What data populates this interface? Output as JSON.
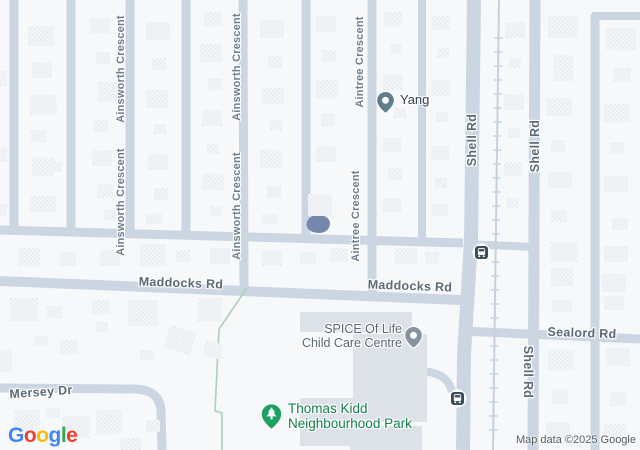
{
  "map": {
    "width": 640,
    "height": 450,
    "background": "#f7f8f9",
    "colors": {
      "road": "#ccd6e2",
      "rail": "#c6d1dd",
      "building": "#e8ebf1",
      "structure": "#dde1e8",
      "water": "#7488ae",
      "park_line": "#abd0b8",
      "street_label": "#6e7d8c",
      "major_label": "#5b6a76"
    }
  },
  "roads": [
    {
      "d": "M14,0 L14,234",
      "w": 9
    },
    {
      "d": "M71,0 L71,234",
      "w": 9
    },
    {
      "d": "M130,0 L130,234",
      "w": 9
    },
    {
      "d": "M186,0 L186,234",
      "w": 9
    },
    {
      "d": "M243,0 L244,296",
      "w": 9
    },
    {
      "d": "M306,0 L306,234",
      "w": 9
    },
    {
      "d": "M372,0 L372,297",
      "w": 9
    },
    {
      "d": "M422,0 L422,240",
      "w": 8
    },
    {
      "d": "M474,0 L471,240 L464,355 L463,450",
      "w": 14
    },
    {
      "d": "M535,0 L533,450",
      "w": 11
    },
    {
      "d": "M595,14 L595,450",
      "w": 9
    },
    {
      "d": "M592,16 L640,16",
      "w": 8
    },
    {
      "d": "M0,230 L463,243",
      "w": 9
    },
    {
      "d": "M464,244 L535,247",
      "w": 8
    },
    {
      "d": "M0,281 L461,300",
      "w": 10
    },
    {
      "d": "M461,331 L640,339",
      "w": 9
    },
    {
      "d": "M0,388 L136,389 Q159,390 161,410 L162,450",
      "w": 9
    },
    {
      "d": "M420,371 Q448,372 452,392",
      "w": 8
    }
  ],
  "rail": {
    "x_top": 499,
    "x_bottom": 493,
    "tick_spacing": 14,
    "tick_half": 4,
    "y_start": 38,
    "y_end": 438,
    "line_w": 2
  },
  "pond": {
    "d": "M312,216 Q305,221 307,227 Q310,233 320,233 Q329,232 330,224 Q330,217 321,215 Z"
  },
  "park_boundary": {
    "d": "M247,288 L219,329 L215,411 L222,413 L222,450"
  },
  "buildings": [
    [
      28,
      26,
      26,
      20
    ],
    [
      32,
      62,
      20,
      16
    ],
    [
      30,
      95,
      26,
      20
    ],
    [
      47,
      100,
      10,
      8
    ],
    [
      30,
      130,
      16,
      12
    ],
    [
      32,
      158,
      22,
      18
    ],
    [
      52,
      162,
      10,
      10
    ],
    [
      30,
      196,
      26,
      16
    ],
    [
      0,
      70,
      7,
      16
    ],
    [
      0,
      148,
      7,
      14
    ],
    [
      0,
      204,
      7,
      12
    ],
    [
      90,
      18,
      20,
      16
    ],
    [
      96,
      52,
      14,
      12
    ],
    [
      98,
      82,
      22,
      20
    ],
    [
      94,
      120,
      14,
      12
    ],
    [
      92,
      150,
      20,
      16
    ],
    [
      97,
      184,
      16,
      14
    ],
    [
      104,
      210,
      12,
      10
    ],
    [
      146,
      22,
      24,
      18
    ],
    [
      152,
      58,
      14,
      12
    ],
    [
      146,
      90,
      22,
      18
    ],
    [
      154,
      124,
      12,
      10
    ],
    [
      148,
      154,
      20,
      16
    ],
    [
      154,
      188,
      14,
      12
    ],
    [
      146,
      214,
      16,
      10
    ],
    [
      204,
      12,
      18,
      14
    ],
    [
      200,
      44,
      22,
      18
    ],
    [
      208,
      78,
      14,
      12
    ],
    [
      202,
      110,
      20,
      16
    ],
    [
      207,
      144,
      12,
      10
    ],
    [
      202,
      174,
      22,
      16
    ],
    [
      210,
      206,
      12,
      10
    ],
    [
      260,
      20,
      24,
      18
    ],
    [
      268,
      56,
      14,
      12
    ],
    [
      262,
      88,
      22,
      16
    ],
    [
      270,
      120,
      12,
      10
    ],
    [
      260,
      150,
      22,
      18
    ],
    [
      267,
      186,
      14,
      12
    ],
    [
      262,
      214,
      16,
      10
    ],
    [
      316,
      16,
      20,
      16
    ],
    [
      322,
      50,
      14,
      12
    ],
    [
      316,
      80,
      22,
      18
    ],
    [
      321,
      114,
      14,
      12
    ],
    [
      316,
      146,
      20,
      16
    ],
    [
      308,
      194,
      24,
      22
    ],
    [
      384,
      12,
      18,
      14
    ],
    [
      390,
      44,
      12,
      10
    ],
    [
      383,
      74,
      20,
      16
    ],
    [
      394,
      108,
      12,
      10
    ],
    [
      383,
      138,
      18,
      14
    ],
    [
      388,
      168,
      14,
      12
    ],
    [
      383,
      198,
      18,
      14
    ],
    [
      432,
      16,
      18,
      14
    ],
    [
      437,
      48,
      12,
      10
    ],
    [
      431,
      80,
      20,
      16
    ],
    [
      436,
      112,
      12,
      10
    ],
    [
      431,
      146,
      18,
      14
    ],
    [
      435,
      178,
      12,
      10
    ],
    [
      432,
      204,
      16,
      12
    ],
    [
      505,
      22,
      20,
      16
    ],
    [
      509,
      58,
      12,
      10
    ],
    [
      504,
      94,
      20,
      16
    ],
    [
      508,
      128,
      12,
      10
    ],
    [
      504,
      162,
      18,
      14
    ],
    [
      507,
      198,
      12,
      10
    ],
    [
      548,
      16,
      30,
      22
    ],
    [
      553,
      55,
      20,
      26
    ],
    [
      546,
      98,
      26,
      18
    ],
    [
      551,
      140,
      14,
      12
    ],
    [
      548,
      172,
      24,
      16
    ],
    [
      551,
      210,
      16,
      12
    ],
    [
      550,
      242,
      28,
      20
    ],
    [
      551,
      268,
      22,
      18
    ],
    [
      552,
      300,
      20,
      12
    ],
    [
      548,
      350,
      26,
      20
    ],
    [
      552,
      390,
      16,
      14
    ],
    [
      546,
      422,
      24,
      18
    ],
    [
      606,
      28,
      30,
      22
    ],
    [
      613,
      68,
      18,
      14
    ],
    [
      604,
      104,
      26,
      18
    ],
    [
      610,
      142,
      14,
      12
    ],
    [
      604,
      176,
      24,
      16
    ],
    [
      612,
      218,
      16,
      12
    ],
    [
      604,
      246,
      24,
      16
    ],
    [
      602,
      274,
      24,
      18
    ],
    [
      604,
      296,
      20,
      14
    ],
    [
      606,
      348,
      24,
      18
    ],
    [
      610,
      392,
      16,
      14
    ],
    [
      604,
      424,
      22,
      14
    ],
    [
      18,
      248,
      22,
      18
    ],
    [
      60,
      252,
      16,
      14
    ],
    [
      100,
      250,
      20,
      16
    ],
    [
      140,
      244,
      26,
      22
    ],
    [
      176,
      250,
      14,
      12
    ],
    [
      210,
      248,
      20,
      16
    ],
    [
      262,
      250,
      20,
      16
    ],
    [
      300,
      252,
      16,
      12
    ],
    [
      330,
      248,
      18,
      14
    ],
    [
      395,
      248,
      22,
      16
    ],
    [
      425,
      252,
      14,
      12
    ],
    [
      10,
      298,
      28,
      24
    ],
    [
      46,
      306,
      16,
      12
    ],
    [
      92,
      300,
      18,
      14
    ],
    [
      128,
      300,
      30,
      26
    ],
    [
      198,
      298,
      24,
      24
    ],
    [
      0,
      350,
      12,
      22
    ],
    [
      34,
      336,
      14,
      10
    ],
    [
      60,
      340,
      18,
      14
    ],
    [
      96,
      322,
      12,
      10
    ],
    [
      166,
      328,
      28,
      24,
      18
    ],
    [
      204,
      342,
      18,
      16,
      12
    ],
    [
      140,
      350,
      14,
      10
    ],
    [
      14,
      410,
      26,
      22
    ],
    [
      46,
      408,
      14,
      10
    ],
    [
      62,
      416,
      28,
      22
    ],
    [
      96,
      410,
      26,
      24
    ],
    [
      120,
      438,
      22,
      12
    ],
    [
      146,
      420,
      14,
      12
    ]
  ],
  "structures": [
    [
      300,
      312,
      112,
      20
    ],
    [
      353,
      334,
      74,
      88
    ],
    [
      300,
      398,
      58,
      48
    ],
    [
      350,
      426,
      72,
      24
    ]
  ],
  "street_labels": [
    {
      "text": "Ainsworth Crescent",
      "x": 121,
      "y": 69,
      "rot": -90,
      "cls": "minor"
    },
    {
      "text": "Ainsworth Crescent",
      "x": 121,
      "y": 202,
      "rot": -90,
      "cls": "minor"
    },
    {
      "text": "Ainsworth Crescent",
      "x": 237,
      "y": 67,
      "rot": -90,
      "cls": "minor"
    },
    {
      "text": "Ainsworth Crescent",
      "x": 237,
      "y": 206,
      "rot": -90,
      "cls": "minor"
    },
    {
      "text": "Aintree Crescent",
      "x": 360,
      "y": 62,
      "rot": -90,
      "cls": "minor"
    },
    {
      "text": "Aintree Crescent",
      "x": 356,
      "y": 216,
      "rot": -90,
      "cls": "minor"
    },
    {
      "text": "Shell Rd",
      "x": 472,
      "y": 140,
      "rot": -90,
      "cls": "major"
    },
    {
      "text": "Shell Rd",
      "x": 535,
      "y": 146,
      "rot": -90,
      "cls": "major"
    },
    {
      "text": "Shell Rd",
      "x": 528,
      "y": 372,
      "rot": 90,
      "cls": "major"
    },
    {
      "text": "Maddocks Rd",
      "x": 181,
      "y": 283,
      "rot": 2,
      "cls": "major"
    },
    {
      "text": "Maddocks Rd",
      "x": 410,
      "y": 286,
      "rot": 2,
      "cls": "major"
    },
    {
      "text": "Sealord Rd",
      "x": 582,
      "y": 333,
      "rot": 2,
      "cls": "major"
    },
    {
      "text": "Mersey Dr",
      "x": 41,
      "y": 392,
      "rot": -4,
      "cls": "major"
    }
  ],
  "pois": [
    {
      "id": "yang",
      "lines": [
        "Yang"
      ],
      "label_x": 400,
      "label_y": 93,
      "align": "left",
      "color": "#323e48",
      "size": 13,
      "pin": {
        "x": 385,
        "y": 100,
        "color": "#5f7d8c",
        "glyph": "dot"
      }
    },
    {
      "id": "spice-of-life-child-care-centre",
      "lines": [
        "SPICE Of Life",
        "Child Care Centre"
      ],
      "label_x": 402,
      "label_y": 323,
      "align": "right",
      "color": "#5a6872",
      "size": 12.5,
      "pin": {
        "x": 413,
        "y": 335,
        "color": "#8593a0",
        "glyph": "dot"
      }
    },
    {
      "id": "thomas-kidd-neighbourhood-park",
      "lines": [
        "Thomas Kidd",
        "Neighbourhood Park"
      ],
      "label_x": 288,
      "label_y": 402,
      "align": "left",
      "color": "#12814a",
      "size": 13.5,
      "pin": {
        "x": 271,
        "y": 414,
        "color": "#1da160",
        "glyph": "tree"
      }
    }
  ],
  "transit_stops": [
    {
      "x": 481,
      "y": 252
    },
    {
      "x": 457,
      "y": 398
    }
  ],
  "logo": {
    "letters": [
      {
        "ch": "G",
        "color": "#4285F4"
      },
      {
        "ch": "o",
        "color": "#EA4335"
      },
      {
        "ch": "o",
        "color": "#FBBC05"
      },
      {
        "ch": "g",
        "color": "#4285F4"
      },
      {
        "ch": "l",
        "color": "#34A853"
      },
      {
        "ch": "e",
        "color": "#EA4335"
      }
    ]
  },
  "attribution": "Map data ©2025 Google"
}
